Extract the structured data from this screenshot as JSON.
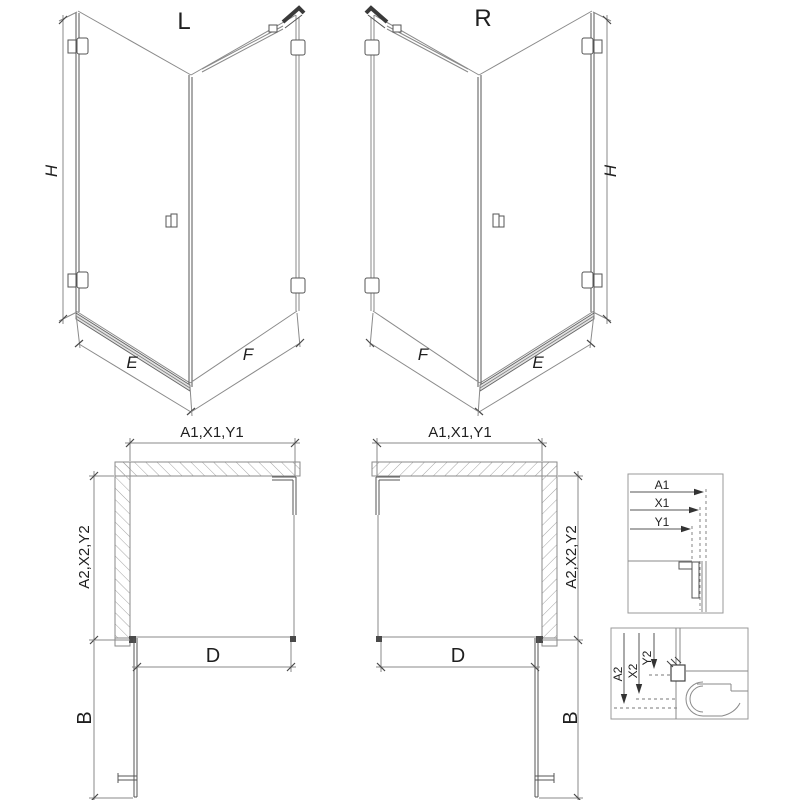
{
  "drawing": {
    "title": "shower-enclosure-technical-drawing",
    "variant_left": {
      "label": "L",
      "height_dim": "H",
      "door_width_dim": "E",
      "panel_width_dim": "F"
    },
    "variant_right": {
      "label": "R",
      "height_dim": "H",
      "door_width_dim": "E",
      "panel_width_dim": "F"
    },
    "plan_left": {
      "width_dim": "A1,X1,Y1",
      "depth_dim": "A2,X2,Y2",
      "inner_width_dim": "D",
      "door_swing_dim": "B"
    },
    "plan_right": {
      "width_dim": "A1,X1,Y1",
      "depth_dim": "A2,X2,Y2",
      "inner_width_dim": "D",
      "door_swing_dim": "B"
    },
    "detail_wall_profile": {
      "dim_a": "A1",
      "dim_x": "X1",
      "dim_y": "Y1"
    },
    "detail_tray_profile": {
      "dim_a": "A2",
      "dim_x": "X2",
      "dim_y": "Y2"
    },
    "colors": {
      "line": "#8a8a8a",
      "dark_line": "#555555",
      "bracket": "#3a3a3a",
      "hatch": "#9a9a9a",
      "text": "#1f1f1f",
      "background": "#ffffff"
    }
  }
}
